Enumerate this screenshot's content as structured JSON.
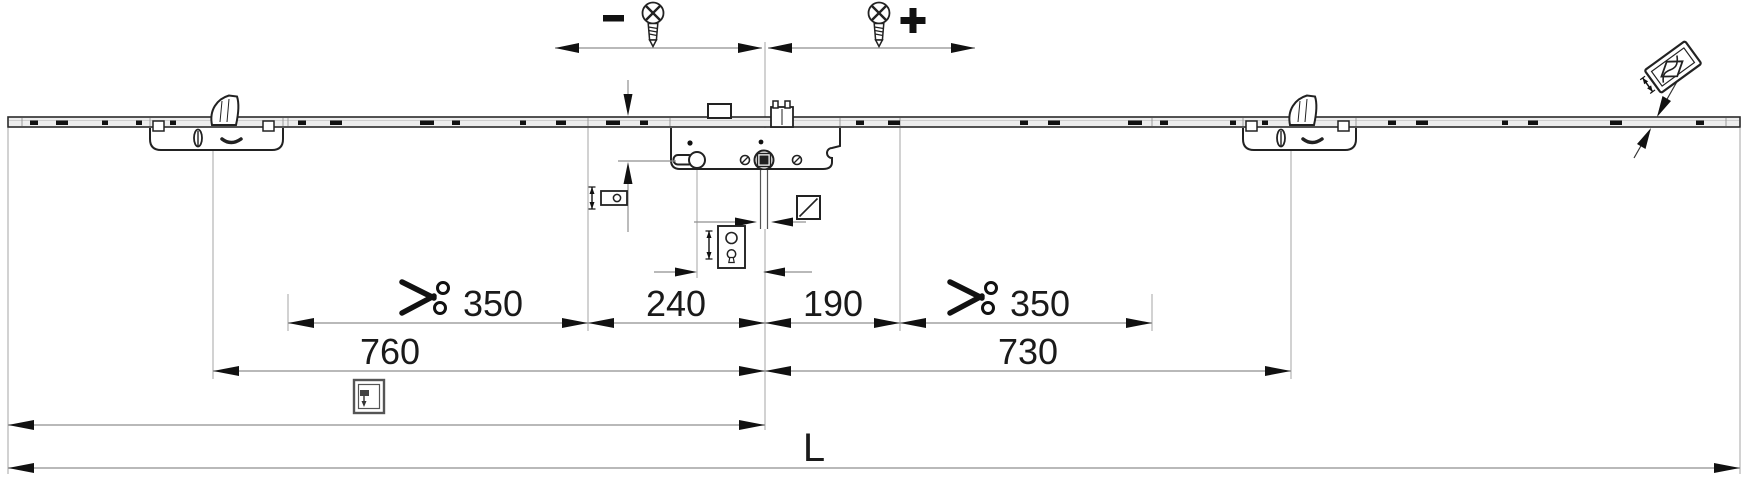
{
  "title": "Multipoint espagnolette lock — installation dimension drawing",
  "labels": {
    "minus": "−",
    "plus": "+",
    "cut_left": "350",
    "center_left": "240",
    "center_right": "190",
    "cut_right": "350",
    "span_left": "760",
    "span_right": "730",
    "total_length": "L"
  },
  "dimension_rows": [
    {
      "row": "adjustment",
      "labels": [
        "−",
        "+"
      ]
    },
    {
      "row": "chain",
      "values": [
        "350",
        "240",
        "190",
        "350"
      ]
    },
    {
      "row": "spans",
      "values": [
        "760",
        "730"
      ]
    },
    {
      "row": "total",
      "values": [
        "L"
      ]
    }
  ],
  "colors": {
    "ink": "#1a1a1a",
    "dim_line": "#8f8f8f",
    "reference_line": "#b3b3b3",
    "rail_fill": "#ededed"
  },
  "icons": [
    "screw-icon",
    "minus-symbol",
    "plus-symbol",
    "scissors-icon",
    "backset-gauge-icon",
    "hub-to-cylinder-gauge-icon",
    "spindle-square-icon",
    "window-handle-height-icon",
    "faceplate-section-icon"
  ]
}
